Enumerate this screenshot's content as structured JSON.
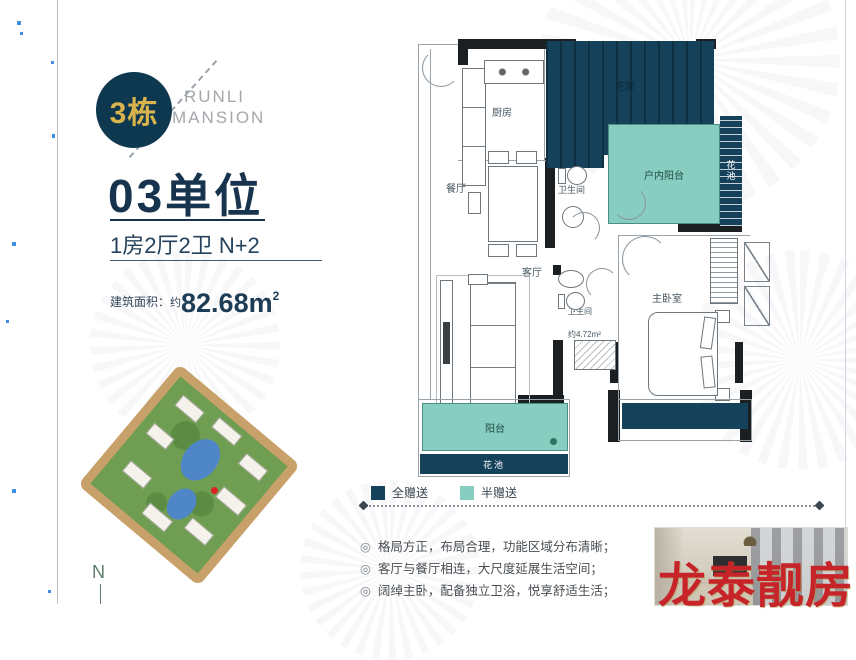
{
  "badge": {
    "building": "3栋"
  },
  "brand": {
    "line1": "RUNLI",
    "line2": "MANSION"
  },
  "unit": {
    "title": "03单位",
    "layout": "1房2厅2卫 N+2",
    "area_label": "建筑面积：",
    "area_prefix": "约",
    "area_value": "82.68m",
    "area_sup": "2"
  },
  "site_plan": {
    "compass": "N"
  },
  "floor_plan": {
    "rooms": {
      "kitchen": "厨房",
      "flower_rack": "花架",
      "dining": "餐厅",
      "bathroom_upper": "卫生间",
      "indoor_balcony": "户内阳台",
      "flower_bed_right": "花池",
      "living": "客厅",
      "bathroom_lower": "卫生间",
      "bathroom_lower_area": "约4.72m²",
      "master_bedroom": "主卧室",
      "balcony": "阳台",
      "flower_bed_bottom": "花池"
    },
    "legend": {
      "full_gift": {
        "label": "全赠送",
        "color": "#15425a"
      },
      "half_gift": {
        "label": "半赠送",
        "color": "#87cdc0"
      }
    }
  },
  "features": {
    "bullet": "◎",
    "items": [
      "格局方正，布局合理，功能区域分布清晰；",
      "客厅与餐厅相连，大尺度延展生活空间；",
      "阔绰主卧，配备独立卫浴，悦享舒适生活；"
    ]
  },
  "watermark": {
    "text": "龙泰靓房",
    "color": "#c7242a"
  },
  "colors": {
    "navy": "#15425a",
    "teal": "#87cdc0",
    "badge_bg": "#0e384f",
    "badge_text": "#d9b34c",
    "title_navy": "#17334d"
  }
}
